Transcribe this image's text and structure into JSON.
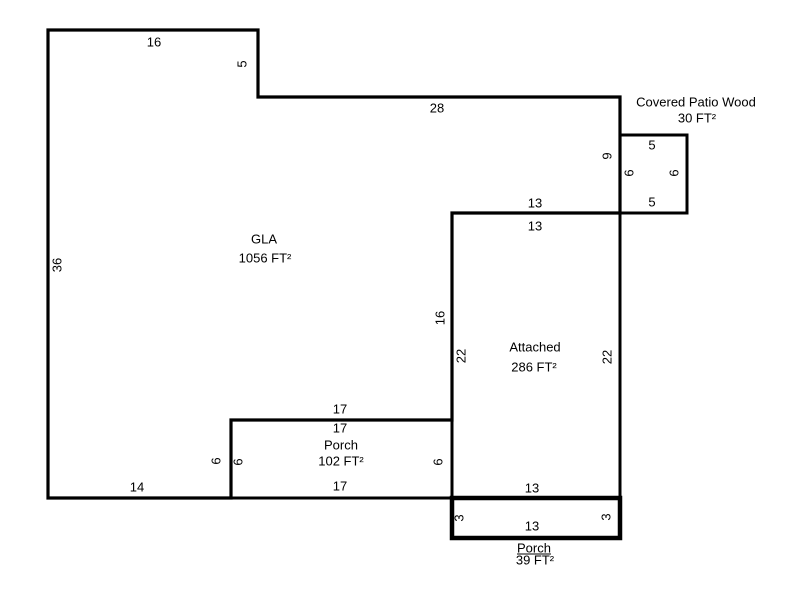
{
  "colors": {
    "background": "#ffffff",
    "line": "#000000",
    "text": "#000000"
  },
  "areas": {
    "gla": {
      "name": "GLA",
      "sqft": "1056 FT²"
    },
    "attached": {
      "name": "Attached",
      "sqft": "286 FT²"
    },
    "porch_main": {
      "name": "Porch",
      "sqft": "102 FT²"
    },
    "covered_patio_wood": {
      "name": "Covered Patio Wood",
      "sqft": "30 FT²"
    },
    "porch_small": {
      "name": "Porch",
      "sqft": "39 FT²"
    }
  },
  "dims": {
    "gla_top": "16",
    "gla_notch": "5",
    "gla_upper": "28",
    "gla_left": "36",
    "gla_right": "9",
    "patio_top": "5",
    "patio_left": "6",
    "patio_right": "6",
    "patio_bottom": "5",
    "attached_top_outer": "13",
    "attached_top_inner": "13",
    "gla_inner_right": "16",
    "attached_left": "22",
    "attached_right": "22",
    "porch_top_outer": "17",
    "porch_top_inner": "17",
    "porch_left_outer": "6",
    "porch_left_inner": "6",
    "porch_right": "6",
    "porch_bottom": "17",
    "gla_bottom": "14",
    "attached_bottom": "13",
    "porch_small_inner": "13",
    "porch_small_left": "3",
    "porch_small_right": "3"
  }
}
